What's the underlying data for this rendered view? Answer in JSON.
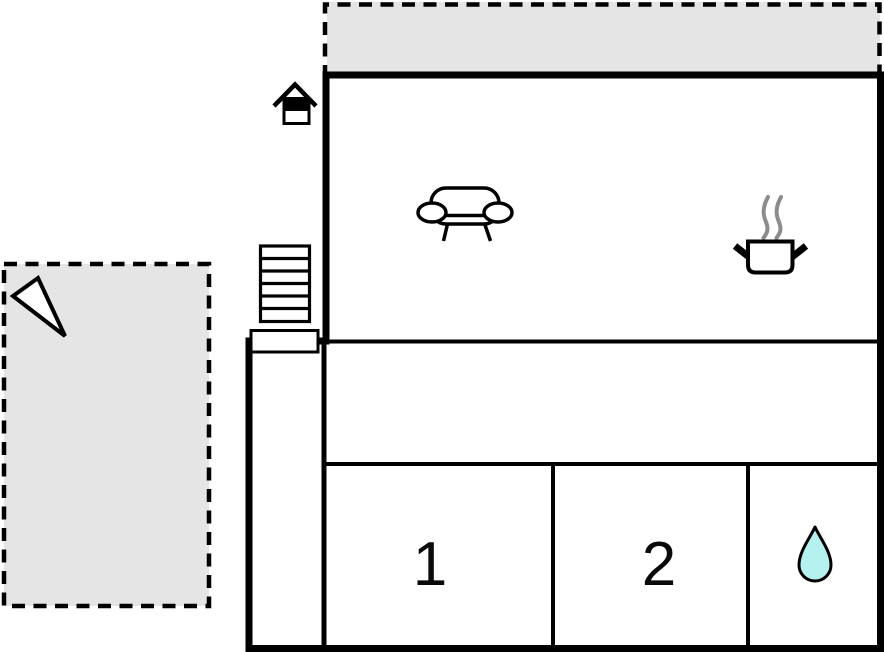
{
  "floorplan": {
    "kind": "holiday-home-floor-plan",
    "rooms": {
      "bedroom1_label": "1",
      "bedroom2_label": "2"
    },
    "icons": {
      "sofa": "sofa-icon (living room)",
      "cooking_pot": "cooking-pot-icon (kitchen)",
      "water_drop": "water-drop-icon (bathroom)",
      "stairs": "stairs-icon (entrance steps)",
      "annex_house": "house-annex-icon",
      "north_arrow": "north-arrow-icon"
    },
    "colors": {
      "terrace_fill": "#e5e5e5",
      "wall": "#000000",
      "water_drop_fill": "#b5f1ef",
      "steam": "#8c8c8c",
      "background": "#ffffff"
    }
  }
}
